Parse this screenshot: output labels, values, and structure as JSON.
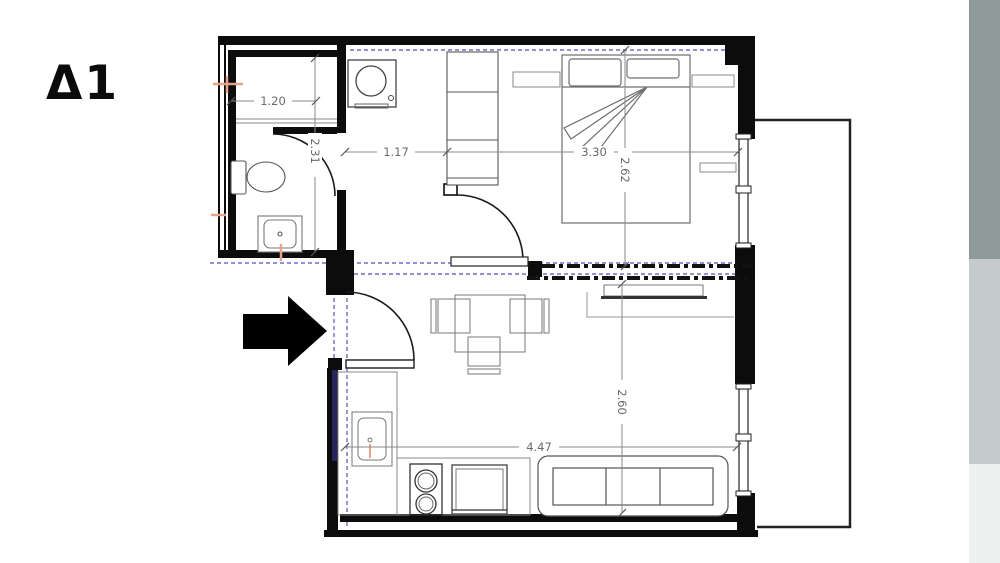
{
  "title": "Δ1",
  "dimensions": {
    "bathroom_width_m": "1.20",
    "bathroom_depth_m": "2.31",
    "hallway_width_m": "1.17",
    "bedroom_width_m": "3.30",
    "bedroom_depth_m": "2.62",
    "living_width_m": "4.47",
    "living_depth_m": "2.60"
  },
  "colors": {
    "wall": "#0c0c0c",
    "entry_wall_navy": "#26265e",
    "furniture_line": "#6f6f6f",
    "dimension_line": "#8a8a8a",
    "dimension_text": "#6a6a6a",
    "section_line_blue": "#5252b8",
    "fixture_accent_orange": "#e8a38b",
    "sidebar_band_top": "#8e9a98",
    "sidebar_band_mid": "#c5cbca",
    "sidebar_band_bottom": "#eef0ef"
  }
}
